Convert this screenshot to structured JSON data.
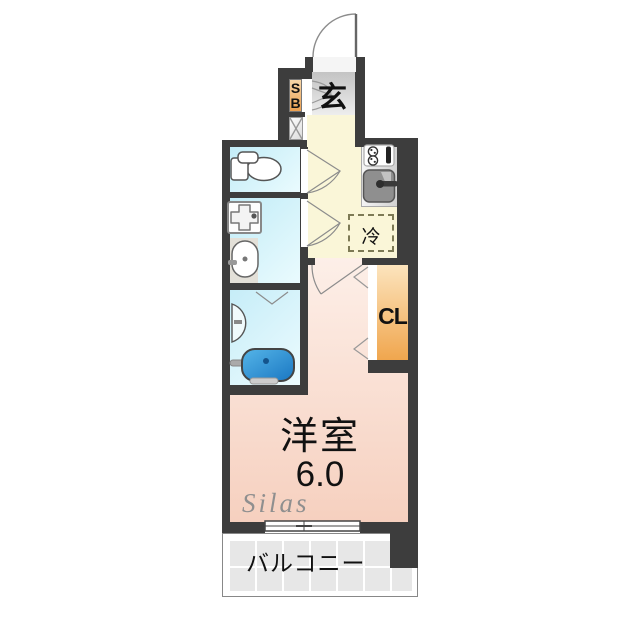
{
  "floorplan": {
    "labels": {
      "entrance": "玄",
      "shoe_box_s": "S",
      "shoe_box_b": "B",
      "refrigerator": "冷",
      "closet": "CL",
      "room_name": "洋室",
      "room_size": "6.0",
      "balcony": "バルコニー",
      "watermark": "Silas"
    },
    "colors": {
      "wall": "#3d3d3d",
      "wet_area_floor": "#c9edf8",
      "kitchen_floor": "#faf6d8",
      "room_floor": "#f8d8c8",
      "entrance_floor": "#cccccc",
      "shoe_box": "#eca050",
      "closet": "#f0a64e",
      "bathtub": "#2e8fd0",
      "balcony_tile": "#e7e7e7"
    },
    "icons": [
      "entrance-door-swing-icon",
      "shoe-box-doors-icon",
      "pipe-space-x-icon",
      "toilet-icon",
      "washing-machine-pan-icon",
      "washbasin-icon",
      "bathtub-icon",
      "gas-stove-icon",
      "kitchen-sink-icon",
      "door-swing-icon",
      "folding-door-chevron-icon",
      "sliding-window-icon"
    ]
  }
}
